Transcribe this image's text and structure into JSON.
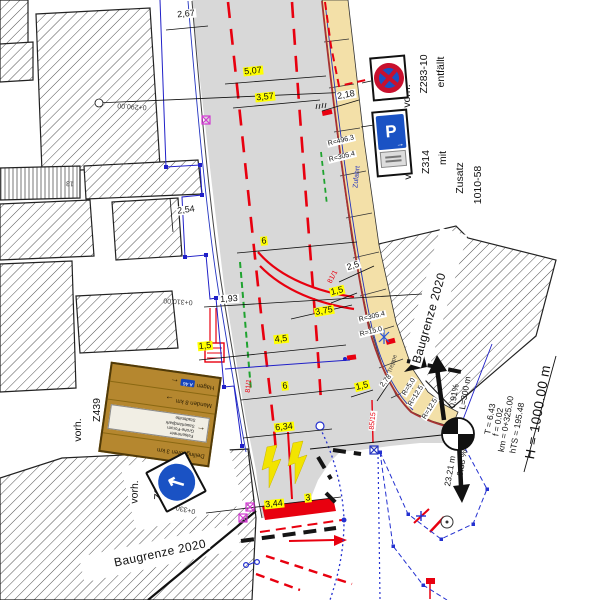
{
  "plan": {
    "boundary_right": "Baugrenze 2020",
    "boundary_bottom": "Baugrenze 2020"
  },
  "stations": {
    "s290": "0+290.00",
    "s310": "0+310.00",
    "s330": "0+330.00"
  },
  "dims": {
    "d267": "2,67",
    "d507": "5,07",
    "d357": "3,57",
    "d218": "2,18",
    "d254": "2,54",
    "d6a": "6",
    "d193": "1,93",
    "d25": "2,5",
    "d15a": "1,5",
    "d375": "3,75",
    "d15b": "1,5",
    "d45": "4,5",
    "d6b": "6",
    "d634": "6,34",
    "d15c": "1,5",
    "d278": "2,78",
    "d344": "3,44",
    "d3": "3"
  },
  "radii": {
    "r4963": "R=496.3",
    "r3054a": "R=305.4",
    "r3054b": "R=305.4",
    "r150": "R=15.0",
    "r50": "R=5.0",
    "r125a": "R=12.5",
    "r125b": "R=12.5"
  },
  "parcels": {
    "p1": "81/1",
    "p2": "81/1",
    "p3": "85/15"
  },
  "notes": {
    "zufahrt": "Zufahrt",
    "treppe": "Treppe",
    "house_no": "13"
  },
  "profile": {
    "h": "H = 1000.00 m",
    "km": "km = 0+325.00",
    "hts": "hTS = 195.48",
    "t": "T = 6.43",
    "f": "f = 0.02",
    "grade_in": "0.91%",
    "length": "L=300 m",
    "grade_out": "0.38 %",
    "dist": "23.21 m"
  },
  "signs": {
    "z283": {
      "label1": "vorh.",
      "label2": "Z283-10",
      "label3": "entfällt"
    },
    "z314": {
      "label1": "vorh.",
      "label2": "Z314",
      "label3": "mit",
      "label4": "Zusatz",
      "label5": "1010-58",
      "letter": "P",
      "arrow": "→"
    },
    "z439": {
      "label1": "vorh.",
      "label2": "Z439",
      "badge": "A 46",
      "row1_text": "Hagen",
      "row2_text": "Menden 8 km",
      "bottom_text": "Deilinghofen 3 km",
      "arrow_left": "←",
      "arrow_right": "→",
      "panel": [
        "Felsenmeer",
        "Grohe-Forum",
        "Sauerlandpark",
        "Stadtmitte"
      ]
    },
    "z222": {
      "label1": "vorh.",
      "label2": "Z222",
      "arrow": "↖"
    }
  },
  "colors": {
    "road": "#d8d8d8",
    "sidewalk": "#f3e0a8",
    "marking_red": "#e8000f",
    "curb_red": "#a63232",
    "boundary_blue": "#2333c0",
    "green": "#1fa32f",
    "magenta": "#d23bd2",
    "highlight": "#ffff00",
    "sign_blue": "#1a52c4",
    "sign_red": "#c8102e",
    "sign_brown": "#b5872f"
  }
}
